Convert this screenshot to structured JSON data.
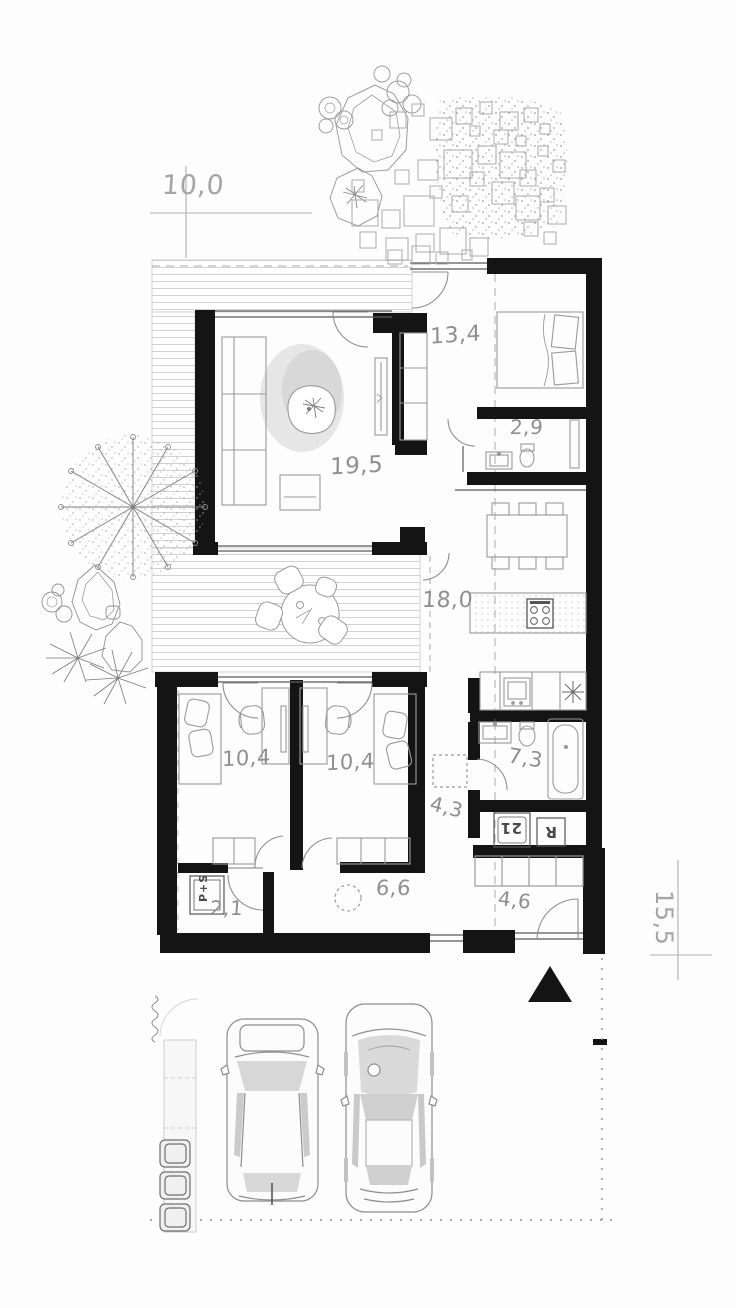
{
  "plan": {
    "name": "single-storey house floor plan",
    "dimensions": {
      "top_width": "10,0",
      "right_depth": "15,5"
    },
    "rooms": {
      "living": {
        "area": "19,5"
      },
      "bedroom": {
        "area": "13,4"
      },
      "wc": {
        "area": "2,9"
      },
      "kitchen_dining": {
        "area": "18,0"
      },
      "kids_left": {
        "area": "10,4"
      },
      "kids_right": {
        "area": "10,4"
      },
      "bathroom": {
        "area": "7,3"
      },
      "hall": {
        "area": "4,3"
      },
      "utility_small": {
        "area": "2,1"
      },
      "corridor": {
        "area": "6,6"
      },
      "entry": {
        "area": "4,6"
      }
    },
    "appliances": {
      "pantry_stack": "P+S",
      "washer": "21",
      "dryer": "R"
    },
    "colors": {
      "wall": "#141414",
      "furniture_line": "#9a9a9a",
      "label": "#8f8f8f",
      "deck_hatch": "#d2d2d2"
    }
  }
}
